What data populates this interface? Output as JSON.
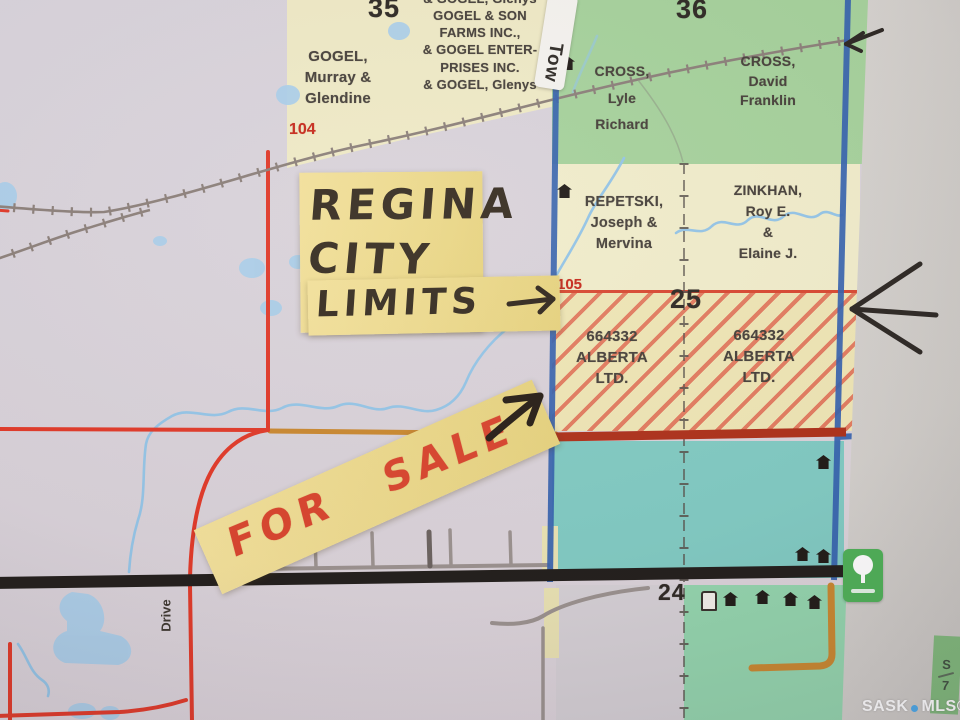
{
  "map": {
    "section_numbers": {
      "nw": "35",
      "ne": "36",
      "center": "25",
      "south": "24"
    },
    "grid_numbers": {
      "west": "104",
      "east": "105"
    },
    "owners": {
      "gogel_corp": "& GOGEL, Glenys\nGOGEL & SON\nFARMS INC.,\n& GOGEL ENTER-\nPRISES INC.\n& GOGEL, Glenys",
      "gogel_murray": "GOGEL,\nMurray &\nGlendine",
      "cross_lyle": "CROSS,\nLyle\nRichard",
      "cross_david": "CROSS,\nDavid\nFranklin",
      "repetski": "REPETSKI,\nJoseph &\nMervina",
      "zinkhan": "ZINKHAN,\nRoy E.\n&\nElaine J.",
      "alberta_west": "664332\nALBERTA\nLTD.",
      "alberta_east": "664332\nALBERTA\nLTD."
    },
    "road_labels": {
      "tower": "Tow",
      "drive": "Drive"
    },
    "page_edge": {
      "top": "S",
      "bottom": "7"
    }
  },
  "annotations": {
    "city_limits_note": {
      "line1": "REGINA",
      "line2": "CITY",
      "line3": "LIMITS",
      "arrow": "→"
    },
    "for_sale_note": {
      "text": "FOR SALE"
    }
  },
  "watermark": {
    "prefix": "SASK",
    "suffix": "MLS®"
  },
  "colors": {
    "city_limits_blue": "#3461ae",
    "hatch_red": "#dd523e",
    "sale_text_red": "#d8432c",
    "note_yellow": "#ecd88c",
    "park_green": "#4db056",
    "highway_black": "#211d1a",
    "water_blue": "#93c4e6"
  }
}
